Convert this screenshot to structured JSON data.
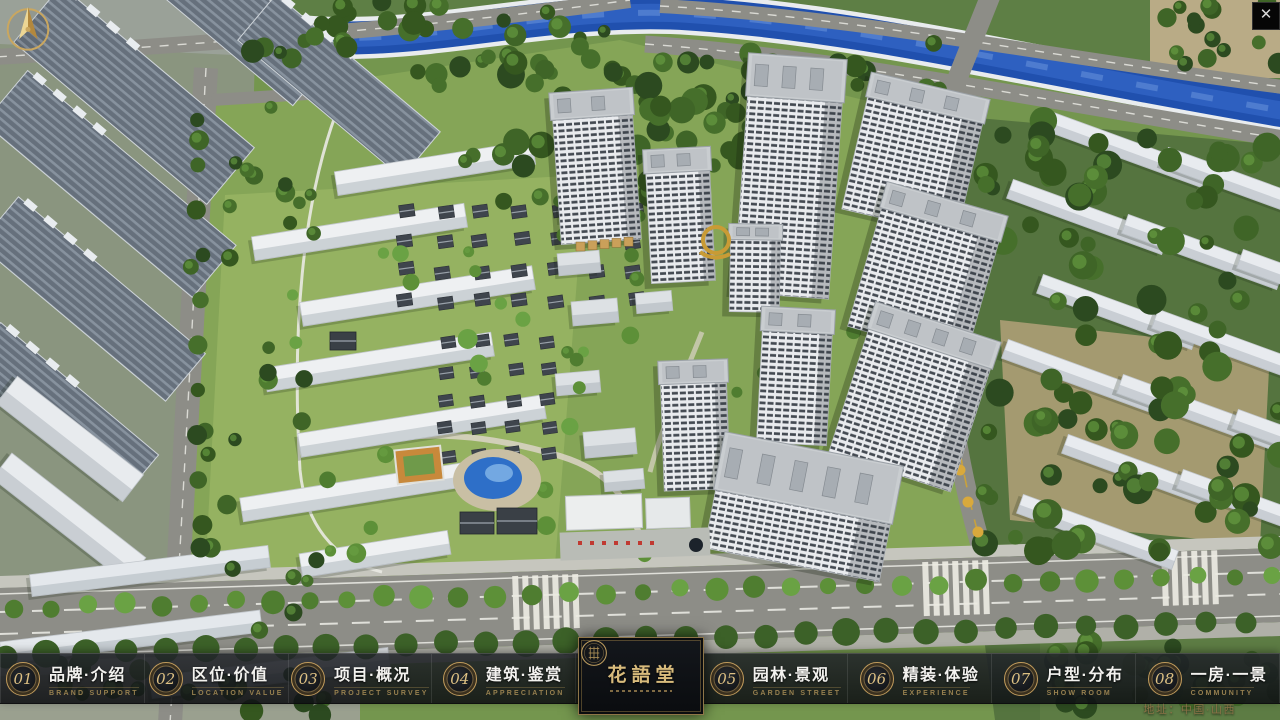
{
  "chrome": {
    "close_label": "✕"
  },
  "icons": {
    "close": "x-glyph",
    "compass": "gold-compass-needle",
    "logo_seal": "round-seal-emblem"
  },
  "menu": {
    "items": [
      {
        "num": "01",
        "zh": "品牌·介绍",
        "en": "BRAND SUPPORT"
      },
      {
        "num": "02",
        "zh": "区位·价值",
        "en": "LOCATION VALUE"
      },
      {
        "num": "03",
        "zh": "项目·概况",
        "en": "PROJECT SURVEY"
      },
      {
        "num": "04",
        "zh": "建筑·鉴赏",
        "en": "APPRECIATION"
      },
      {
        "num": "05",
        "zh": "园林·景观",
        "en": "GARDEN STREET"
      },
      {
        "num": "06",
        "zh": "精装·体验",
        "en": "EXPERIENCE"
      },
      {
        "num": "07",
        "zh": "户型·分布",
        "en": "SHOW ROOM"
      },
      {
        "num": "08",
        "zh": "一房·一景",
        "en": "COMMUNITY"
      }
    ]
  },
  "logo": {
    "name": "花語堂"
  },
  "footer": {
    "address": "地址：中国·山西"
  },
  "colors": {
    "gold": "#c8a566",
    "gold_dim": "#97804f",
    "bar_bg": "#111317",
    "river": "#2050ae",
    "grass": "#7ba052",
    "tree_dark": "#2c4a20",
    "road": "#8d8d87",
    "tower_white": "#e9ebee",
    "slab_blue": "#66707c"
  }
}
